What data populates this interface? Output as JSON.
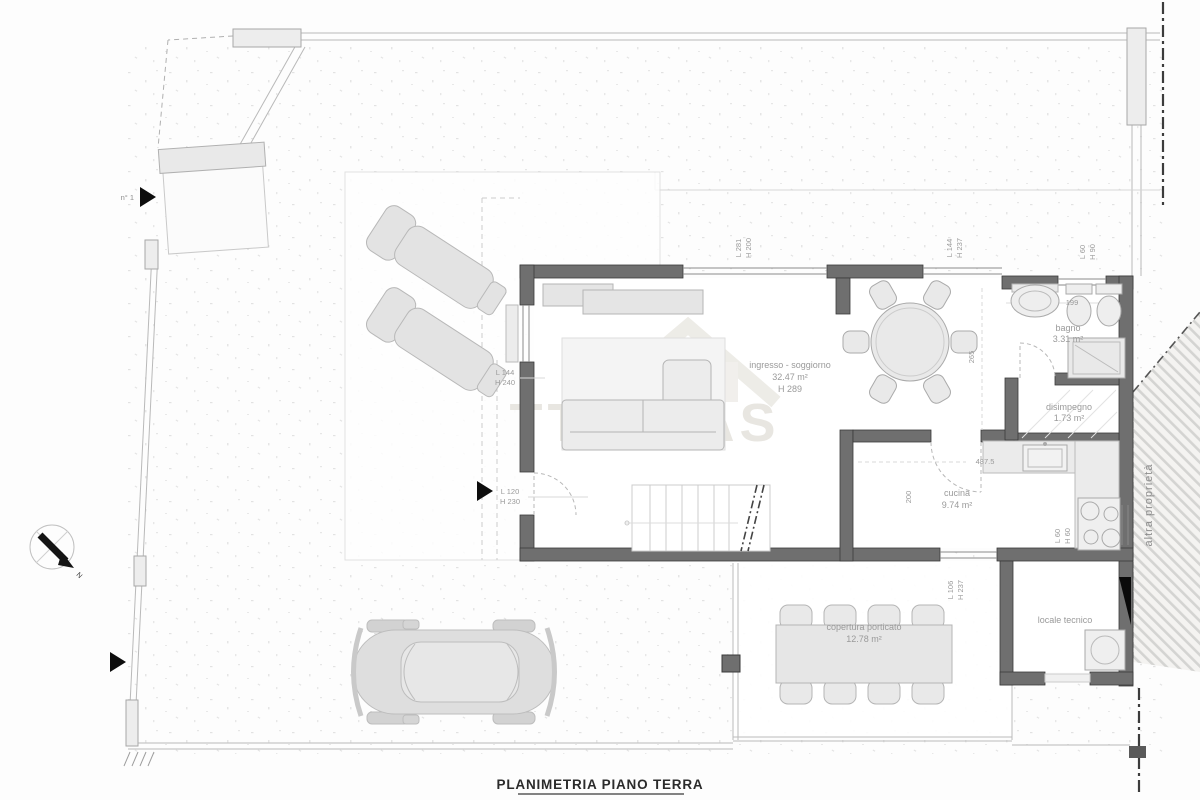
{
  "title": "PLANIMETRIA PIANO TERRA",
  "watermark": "TTO CAS",
  "neighbor_label": "altra proprietà",
  "compass": {
    "north_label": "N"
  },
  "markers": {
    "gate_number": "n° 1"
  },
  "colors": {
    "wall": "#6f6f6f",
    "wall_edge": "#3a3a3a",
    "furniture_fill": "#eaeaea",
    "furniture_stroke": "#b5b5b5",
    "hatch": "#cfcfcf",
    "label_gray": "#9a9a9a",
    "watermark_gray": "#e6e4de"
  },
  "rooms": {
    "soggiorno": {
      "name": "ingresso - soggiorno",
      "area": "32.47 m²",
      "height": "H 289"
    },
    "bagno": {
      "name": "bagno",
      "area": "3.31 m²"
    },
    "disimpegno": {
      "name": "disimpegno",
      "area": "1.73 m²"
    },
    "cucina": {
      "name": "cucina",
      "area": "9.74 m²"
    },
    "locale": {
      "name": "locale tecnico"
    },
    "porticato": {
      "name": "copertura porticato",
      "area": "12.78 m²"
    }
  },
  "dimensions": {
    "w_soggiorno": {
      "l": "L 281",
      "h": "H 200"
    },
    "w_pranzo": {
      "l": "L 144",
      "h": "H 237"
    },
    "w_bagno": {
      "l": "L 60",
      "h": "H 90"
    },
    "w_left": {
      "l": "L 144",
      "h": "H 240"
    },
    "entry_door": {
      "l": "L 120",
      "h": "H 230"
    },
    "w_cucina": {
      "l": "L 60",
      "h": "H 60"
    },
    "porch_door": {
      "l": "L 106",
      "h": "H 237"
    },
    "bagno_width": "199",
    "pranzo_depth": "265",
    "cucina_width": "487.5",
    "cucina_depth": "200"
  }
}
